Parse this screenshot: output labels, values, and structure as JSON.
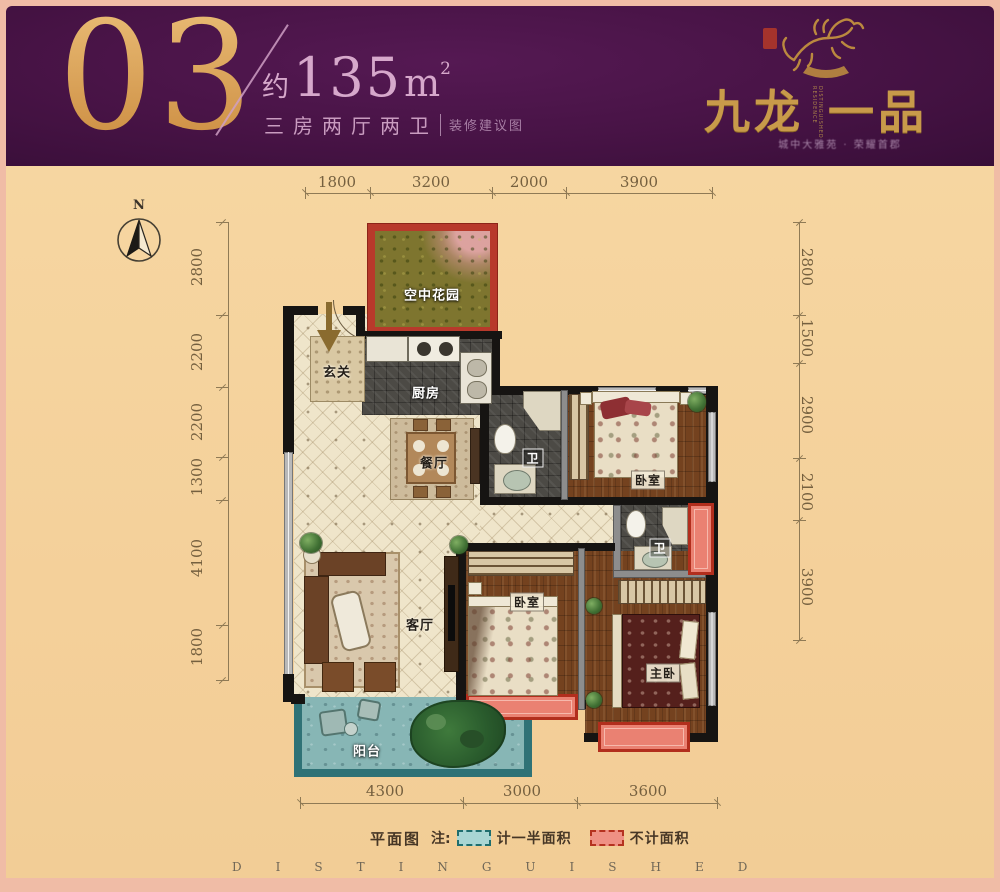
{
  "header": {
    "unit_number": "03",
    "area_prefix": "约",
    "area_value": "135",
    "area_unit": "m",
    "area_power": "2",
    "layout_type": "三房两厅两卫",
    "note": "装修建议图"
  },
  "brand": {
    "name_left": "九龙",
    "name_right": "一品",
    "vertical_text": "DISTINGUISHED RESIDENCE",
    "tagline": "城中大雅苑 · 荣耀首郡"
  },
  "compass": {
    "north_label": "N"
  },
  "dimensions": {
    "top": [
      "1800",
      "3200",
      "2000",
      "3900"
    ],
    "left": [
      "2800",
      "2200",
      "2200",
      "1300",
      "4100",
      "1800"
    ],
    "right": [
      "2800",
      "1500",
      "2900",
      "2100",
      "3900"
    ],
    "bottom": [
      "4300",
      "3000",
      "3600"
    ]
  },
  "rooms": {
    "sky_garden": "空中花园",
    "entry": "玄关",
    "kitchen": "厨房",
    "dining": "餐厅",
    "bath1": "卫",
    "bedroom1": "卧室",
    "bath2": "卫",
    "living": "客厅",
    "bedroom2": "卧室",
    "master": "主卧",
    "balcony": "阳台"
  },
  "legend": {
    "title": "平面图",
    "note_label": "注:",
    "half_area_label": "计一半面积",
    "no_area_label": "不计面积"
  },
  "footer": {
    "watermark": "DISTINGUISHED"
  },
  "colors": {
    "banner_purple": "#471345",
    "gold": "#d8a155",
    "pink_text": "#d3a3c8",
    "paper_tan": "#f5d29b",
    "red_no_area": "#b22e1d",
    "teal_half_area": "#2e7276",
    "frame_salmon": "#f0bca6"
  }
}
